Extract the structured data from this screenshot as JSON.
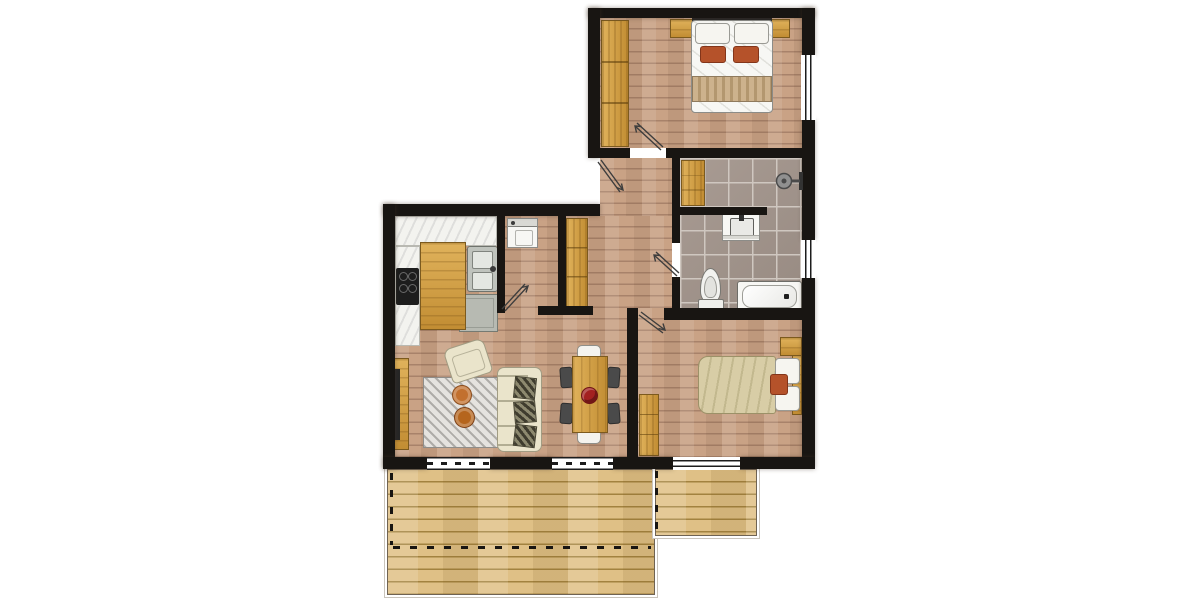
{
  "meta": {
    "title": "apartment-floor-plan",
    "canvas_width": 1200,
    "canvas_height": 600,
    "visible_text": "none"
  },
  "colors": {
    "wall": "#181512",
    "wood_base": "#c9a285",
    "wood_line": "#a8826a",
    "deck_base": "#dfc086",
    "deck_line": "#a2823f",
    "tile_base": "#a1938a",
    "tile_grout": "#cfc7c0",
    "cabinet_light": "#e0b25b",
    "cabinet_dark": "#c28d33",
    "cabinet_border": "#7c5a1e",
    "fixture_white": "#f7f7f4",
    "fixture_border": "#8c8c88",
    "counter_white": "#f3f3ef",
    "counter_border": "#b9b9b2",
    "appliance_gray": "#bfc3bd",
    "accent_orange": "#b5522a",
    "accent_orange_dark": "#83351a",
    "sofa_cream": "#eae4cb",
    "sofa_border": "#a19c83",
    "dark_chair": "#4a4a4a",
    "rug_light": "#e5e3df",
    "rug_stripe": "#aeaca8",
    "bowl_red": "#a32020",
    "tv_dark": "#262626",
    "duvet_tan": "#d8cda6",
    "blanket_tan": "#cdb28d",
    "swing_line": "#3d3d3d"
  },
  "rooms": [
    {
      "id": "bedroom-1",
      "furniture": [
        "double-bed",
        "white-pillows",
        "orange-cushions",
        "foot-blanket",
        "wardrobe",
        "nightstand-left",
        "nightstand-right"
      ]
    },
    {
      "id": "bathroom",
      "furniture": [
        "walk-in-shower",
        "shower-head",
        "vanity-sink",
        "toilet",
        "bathtub",
        "storage-cabinet"
      ]
    },
    {
      "id": "entry-hall",
      "furniture": [
        "hall-wardrobe"
      ]
    },
    {
      "id": "utility-closet",
      "furniture": [
        "washing-machine"
      ]
    },
    {
      "id": "kitchen",
      "furniture": [
        "l-shaped-counter",
        "cooktop",
        "double-sink",
        "under-counter-appliance",
        "island"
      ]
    },
    {
      "id": "living-dining",
      "furniture": [
        "tv-sideboard",
        "tv",
        "armchair",
        "striped-rug",
        "coffee-table-1",
        "coffee-table-2",
        "sofa",
        "patterned-pillows",
        "dining-table",
        "dark-chairs-x4",
        "white-chairs-x2",
        "fruit-bowl"
      ]
    },
    {
      "id": "bedroom-2",
      "furniture": [
        "double-bed",
        "pillows",
        "orange-cushion",
        "nightstand",
        "dresser"
      ]
    },
    {
      "id": "terrace",
      "furniture": [
        "deck-main",
        "deck-side",
        "boundary-dashed-line"
      ]
    }
  ],
  "openings": {
    "doors": [
      "entry-door",
      "bedroom-1-door",
      "bathroom-door",
      "utility-closet-door",
      "bedroom-2-door"
    ],
    "windows": [
      "bedroom-1-window-right",
      "bathroom-window-right",
      "living-window-left",
      "living-window-right",
      "bedroom-2-window-bottom"
    ]
  }
}
